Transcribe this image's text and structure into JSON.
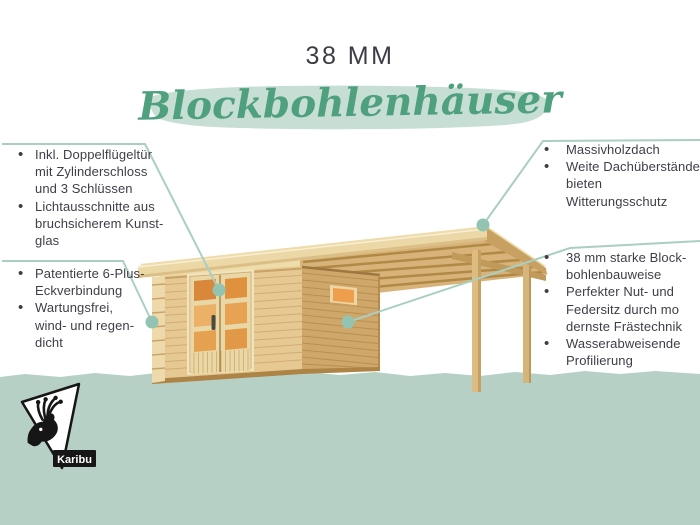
{
  "title": "38 MM",
  "subtitle": "Blockbohlenhäuser",
  "features_left": [
    {
      "items": [
        {
          "lines": [
            "Inkl. Doppelflügeltür",
            "mit Zylinderschloss",
            "und 3 Schlüssen"
          ]
        },
        {
          "lines": [
            "Lichtausschnitte aus",
            "bruchsicherem Kunst-",
            "glas"
          ]
        }
      ]
    },
    {
      "items": [
        {
          "lines": [
            "Patentierte 6-Plus-",
            "Eckverbindung"
          ]
        },
        {
          "lines": [
            "Wartungsfrei,",
            "wind- und regen-",
            "dicht"
          ]
        }
      ]
    }
  ],
  "features_right": [
    {
      "items": [
        {
          "lines": [
            "Massivholzdach"
          ]
        },
        {
          "lines": [
            "Weite Dachüberstände",
            "bieten Witterungsschutz"
          ]
        }
      ]
    },
    {
      "items": [
        {
          "lines": [
            "38 mm starke Block-",
            "bohlenbauweise"
          ]
        },
        {
          "lines": [
            "Perfekter Nut- und",
            "Federsitz durch mo",
            "dernste Frästechnik"
          ]
        },
        {
          "lines": [
            "Wasserabweisende",
            "Profilierung"
          ]
        }
      ]
    }
  ],
  "brand": {
    "logo_label": "Karibu",
    "logo_icon": "deer-antlers-triangle"
  },
  "illustration": {
    "subject": "log-cabin-with-side-canopy",
    "callout_count": 4
  },
  "colors": {
    "accent_green": "#4fa07e",
    "brush_green": "#c6ded3",
    "band_green": "#b6d0c5",
    "callout_line": "#aacfc2",
    "callout_dot": "#92c4b1",
    "text_dark": "#3e3e48",
    "title_dark": "#3c3c46",
    "wood_light": "#ecd8a6",
    "wood_wall": "#e6c893",
    "wood_side": "#cfa76b",
    "glass_orange": "#e59a4a",
    "logo_black": "#161616"
  }
}
